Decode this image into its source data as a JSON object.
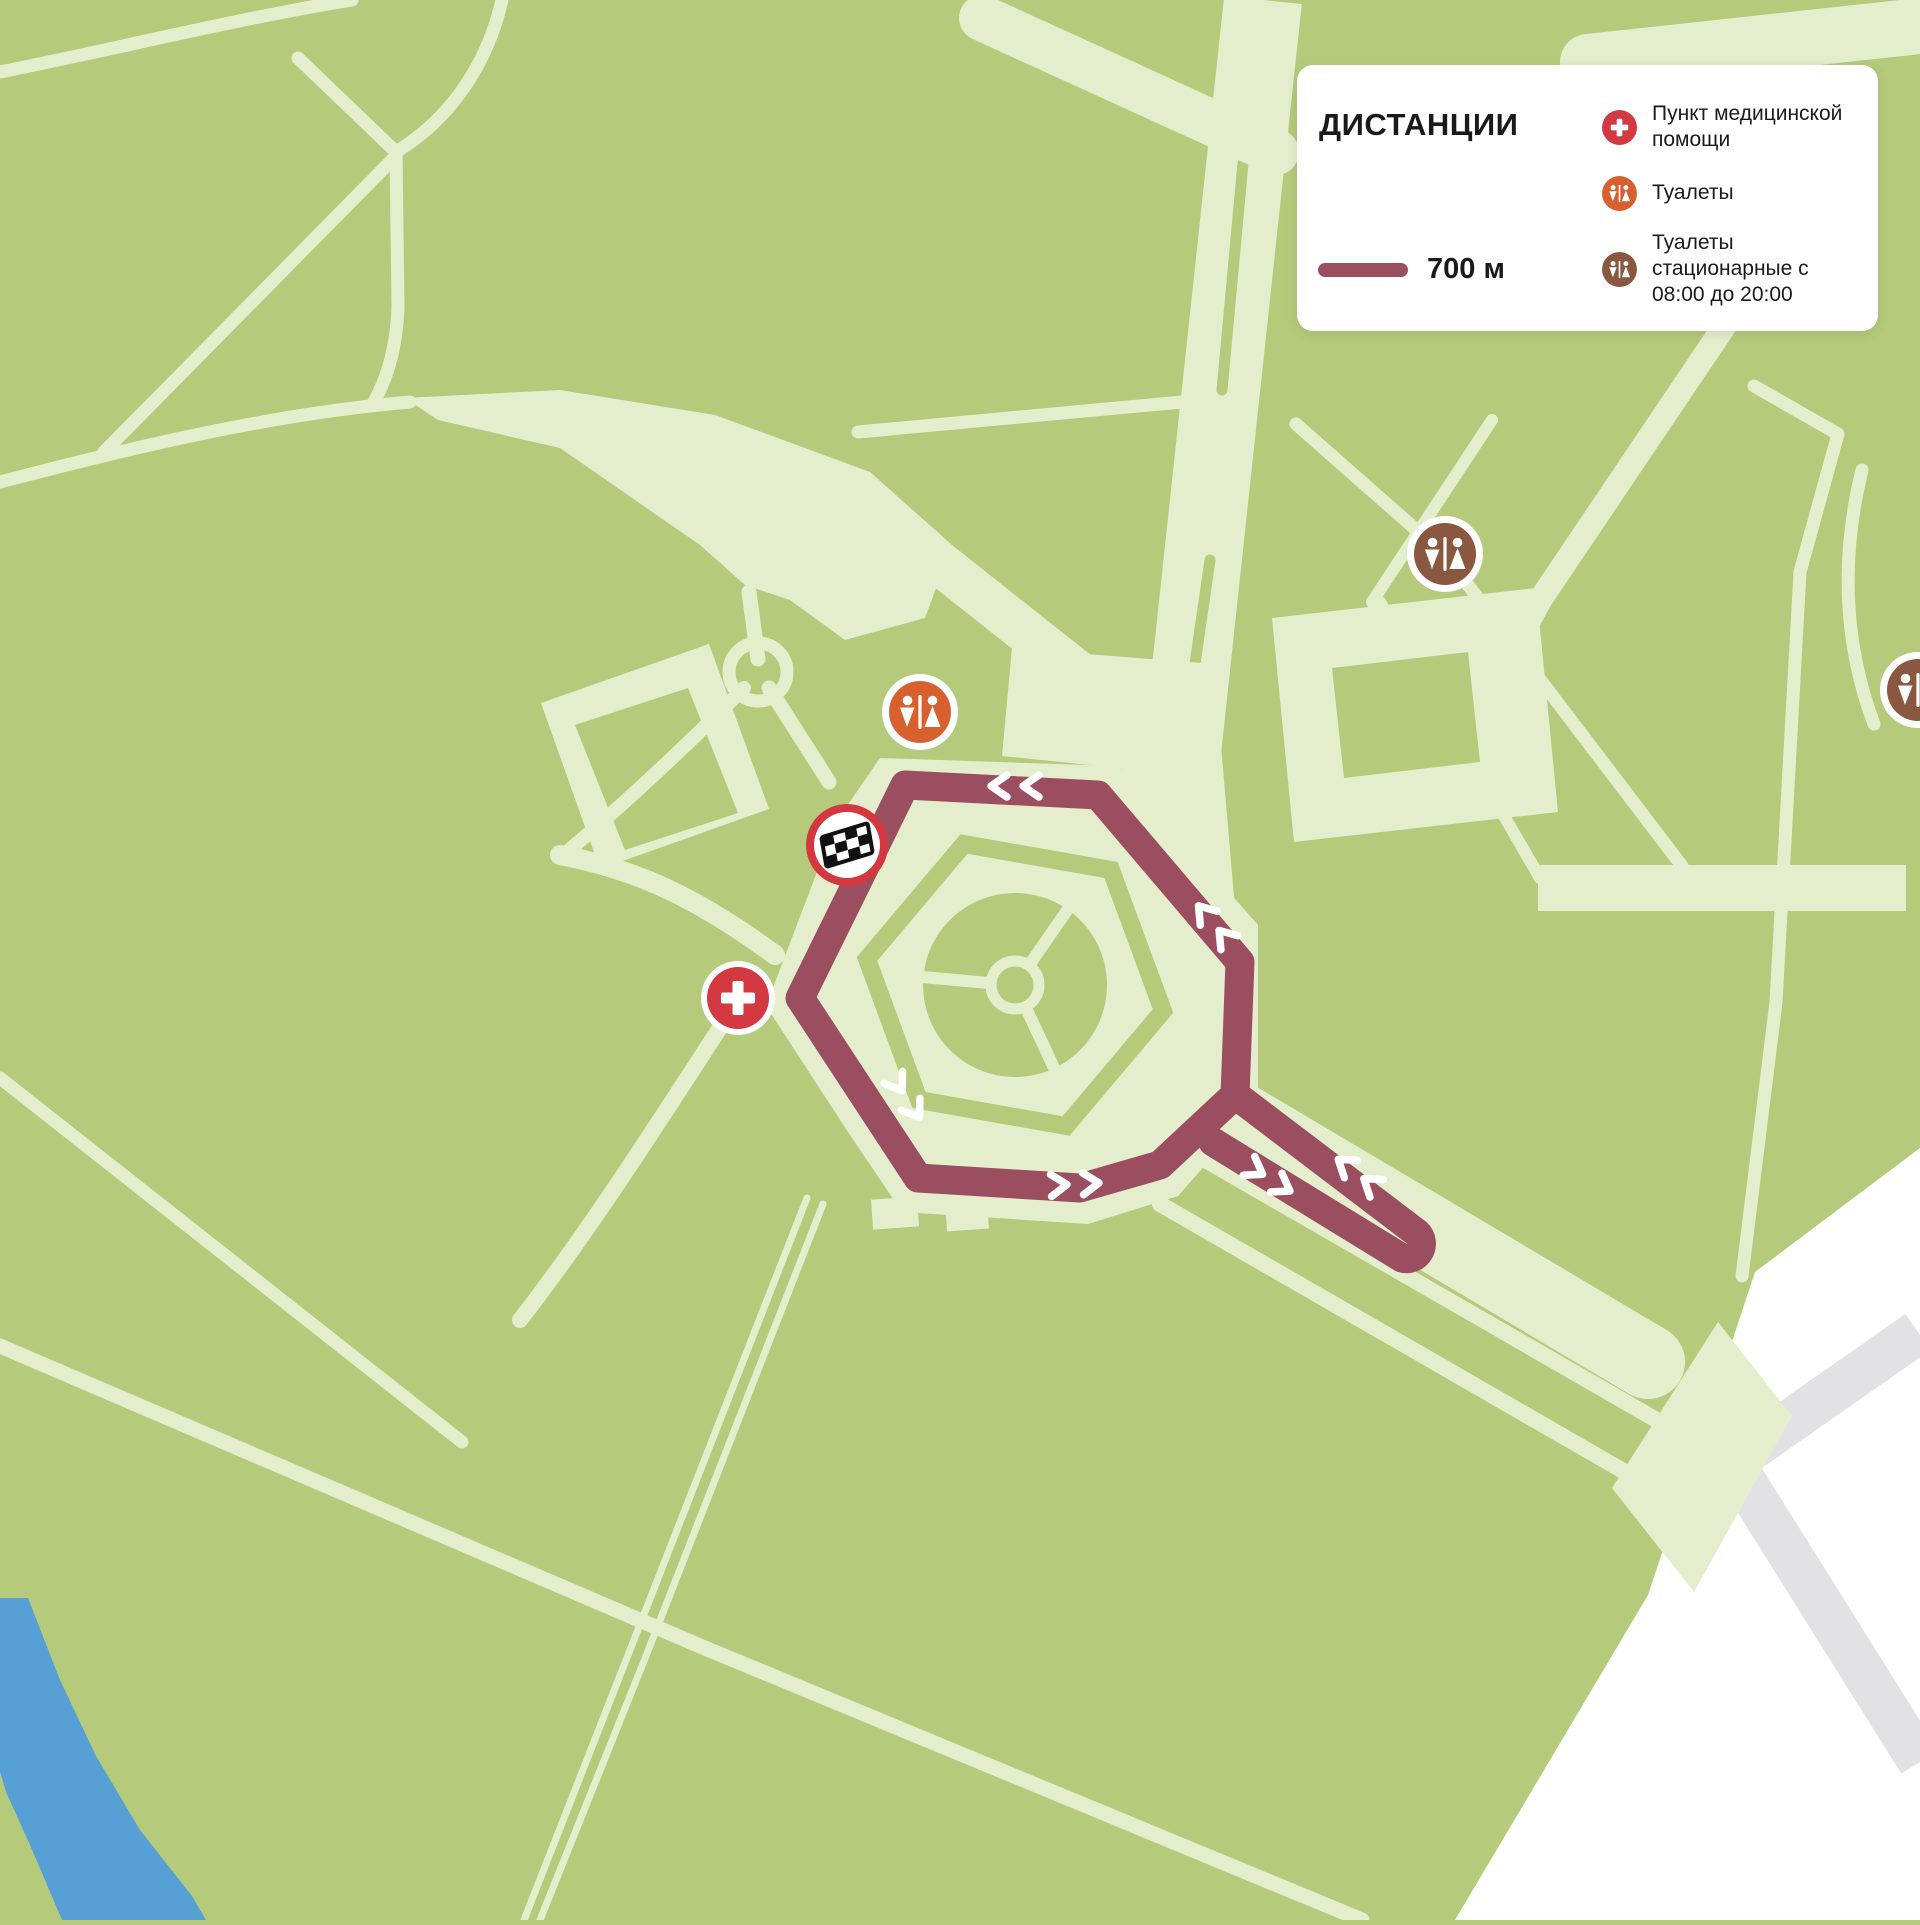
{
  "page": {
    "type": "race-course-park-map"
  },
  "legend": {
    "title": "ДИСТАНЦИИ",
    "distance_label": "700 м",
    "items": [
      {
        "icon": "medical-cross-icon",
        "label": "Пункт медицинской помощи"
      },
      {
        "icon": "toilets-icon",
        "label": "Туалеты"
      },
      {
        "icon": "toilets-stationary-icon",
        "label": "Туалеты стационарные с 08:00 до 20:00"
      }
    ]
  },
  "map": {
    "route": {
      "distance_m": 700,
      "shape": "loop-around-plaza-with-out-and-back-spur",
      "direction_arrow_pairs": 6
    },
    "markers": [
      {
        "name": "toilets",
        "kind": "toilets"
      },
      {
        "name": "finish-flag",
        "kind": "start-finish"
      },
      {
        "name": "medical-point",
        "kind": "medical-aid"
      },
      {
        "name": "toilets-stationary-north",
        "kind": "toilets-stationary"
      },
      {
        "name": "toilets-stationary-east-edge",
        "kind": "toilets-stationary"
      }
    ]
  },
  "colors": {
    "map_green": "#b5cb7b",
    "path_light": "#e4eecd",
    "route": "#9c4e61",
    "medical_red": "#d23940",
    "toilets_orange": "#d8602f",
    "toilets_brown": "#8a5740",
    "water_blue": "#57a0d6",
    "outside_white": "#ffffff",
    "road_gray": "#e2e2e4",
    "flag_ring_red": "#d2383e",
    "text": "#1a1a1a",
    "panel": "#ffffff"
  }
}
